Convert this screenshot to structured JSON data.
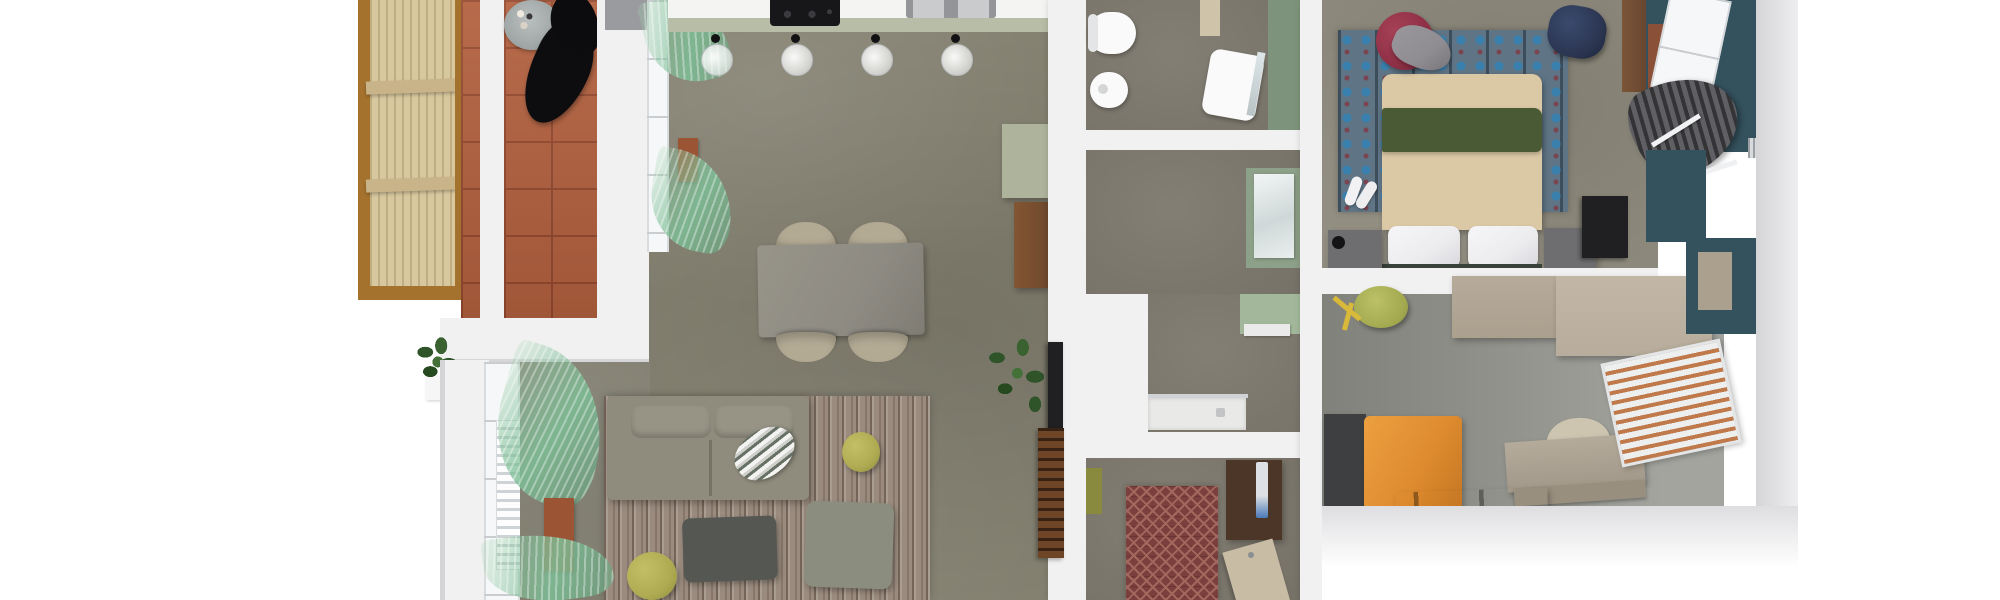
{
  "scene": {
    "type": "3d-rendered-floor-plan",
    "view": "top-down-orthographic",
    "rooms": [
      {
        "id": "balcony",
        "label": "balcony",
        "floor": "terracotta-tile",
        "items": [
          "pergola-slat-screen",
          "bistro-table",
          "bistro-chair-1",
          "bistro-chair-2",
          "potted-plant"
        ]
      },
      {
        "id": "living-dining-kitchen",
        "label": "open-plan living, dining and kitchen",
        "floor": "gray-concrete",
        "items": [
          "kitchen-counter",
          "induction-hob",
          "double-sink",
          "pendant-lamp-1",
          "pendant-lamp-2",
          "pendant-lamp-3",
          "pendant-lamp-4",
          "dining-table",
          "dining-chair-1",
          "dining-chair-2",
          "dining-chair-3",
          "dining-chair-4",
          "sheer-green-curtains",
          "window-radiator",
          "sofa",
          "striped-pillow",
          "wood-stripe-rug",
          "coffee-table",
          "square-ottoman",
          "olive-pouf-1",
          "olive-pouf-2",
          "sage-cabinet",
          "wood-sideboard",
          "potted-plant",
          "wall-tv-panel",
          "slatted-tv-bench",
          "rust-cabinet"
        ]
      },
      {
        "id": "bathroom",
        "label": "bathroom",
        "floor": "gray-concrete",
        "items": [
          "toilet",
          "bidet",
          "vanity-sink",
          "mirror",
          "sage-accent-wall",
          "beige-cabinet"
        ]
      },
      {
        "id": "shower-room",
        "label": "shower room",
        "floor": "gray-concrete",
        "items": [
          "shower-tray",
          "glass-screen",
          "sage-accent-wall",
          "mirror-panel",
          "ledge"
        ]
      },
      {
        "id": "entry-hall",
        "label": "entry hall",
        "floor": "gray-concrete",
        "items": [
          "chevron-runner-rug",
          "entry-wardrobe",
          "intercom-panel",
          "entry-door",
          "olive-mat"
        ]
      },
      {
        "id": "master-bedroom",
        "label": "master bedroom",
        "floor": "gray-concrete",
        "items": [
          "double-bed",
          "green-blanket",
          "pillow-left",
          "pillow-right",
          "patterned-blue-rug",
          "nightstand-left",
          "nightstand-right",
          "maroon-pouf",
          "draped-clothes",
          "navy-pouf",
          "slippers",
          "wall-tv",
          "wood-wall-panel",
          "window",
          "dark-curtains",
          "teal-accent-wall"
        ]
      },
      {
        "id": "kids-room",
        "label": "kids room and study",
        "floor": "gray-concrete",
        "items": [
          "single-bed-orange",
          "dark-headboard-unit",
          "desk",
          "desk-drawer",
          "desk-chair",
          "storage-bench",
          "wardrobe-unit-1",
          "wardrobe-unit-2",
          "olive-cylinder-pouf",
          "toy-sticks",
          "venetian-blind-window",
          "teal-accent-wall"
        ]
      }
    ]
  },
  "palette": {
    "bg": "#ffffff",
    "wall-white": "#f1f1f2",
    "wall-outer": "#d5d5d8",
    "pergola-slat": "#d8c8a0",
    "pergola-slat-dark": "#bfae82",
    "pergola-frame": "#a5722e",
    "pergola-beam": "#c8b488",
    "terracotta": "#b2603e",
    "terracotta-grout": "#94492e",
    "floor-living": "#838070",
    "floor-bath": "#7a756a",
    "floor-bed": "#8d897c",
    "floor-kids": "#90908a",
    "counter-white": "#f4f4f2",
    "counter-edge-sage": "#b7bda6",
    "hob-black": "#17171a",
    "sink-gray": "#939598",
    "pendant-black": "#121214",
    "table-gray": "#8e8b83",
    "chair-beige": "#b3aa94",
    "sofa-body": "#8f8c7d",
    "sofa-cushion": "#979486",
    "rug-chevron-a": "#7b403d",
    "rug-chevron-b": "#a2685d",
    "table-coffee": "#555753",
    "ottoman": "#8b8d7f",
    "pouf-olive": "#aeab52",
    "plant-green": "#2f5429",
    "rust": "#9b5434",
    "wood-sideboard": "#6f482c",
    "sage-cabinet": "#aeb49b",
    "tv-black": "#202022",
    "bench-wood": "#6e4526",
    "fixture-white": "#fafafa",
    "bath-green": "#7e937c",
    "shower-green": "#a3b89b",
    "shower-tray": "#e9e9e7",
    "door-beige": "#c8bca4",
    "cabinet-dark-brown": "#4c3628",
    "rug-bed-base": "#5f7586",
    "rug-bed-dot": "#3a80ae",
    "rug-bed-accent": "#7a4450",
    "duvet": "#dbc8a5",
    "blanket-green": "#4a5a35",
    "pillow-white": "#ececef",
    "nightstand-gray": "#6e6e70",
    "pouf-maroon": "#8c2e44",
    "pouf-navy": "#2b3550",
    "clothes-gray": "#908d92",
    "teal-wall": "#34525e",
    "kids-orange": "#dd8a2e",
    "kids-dark": "#3d3f41",
    "kids-taupe": "#ab9f8e",
    "kids-taupe-light": "#b8ad9c",
    "blind-copper": "#c0794a",
    "olive-dark": "#8a8a3e",
    "yellow-toy": "#d8b93a"
  }
}
